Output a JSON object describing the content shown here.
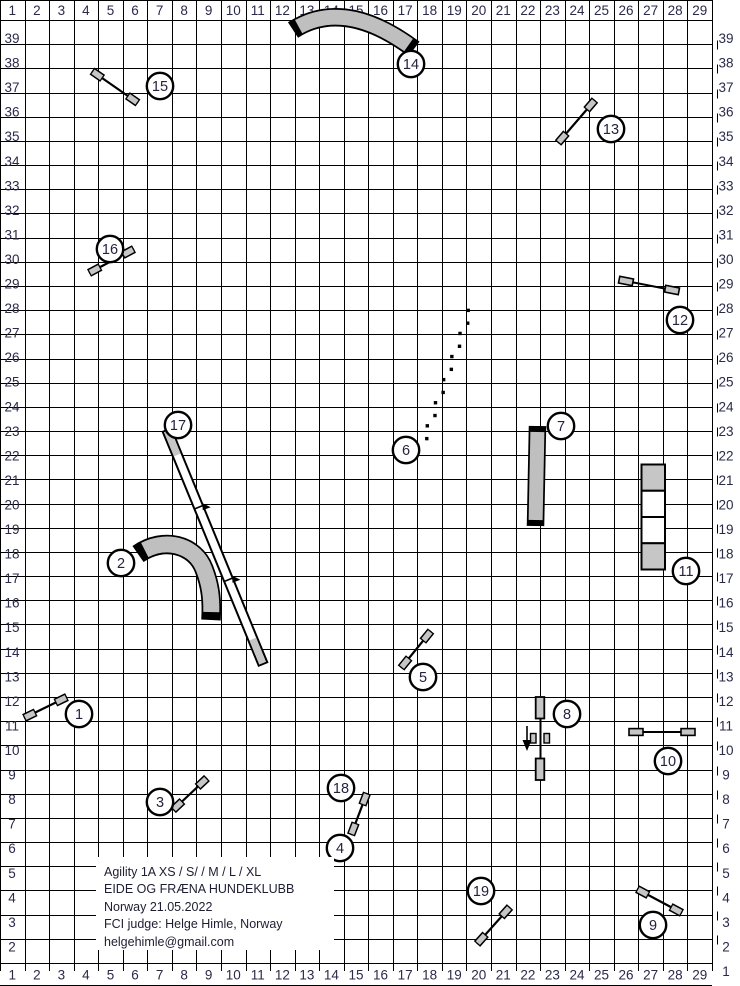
{
  "grid": {
    "columns": [
      "1",
      "2",
      "3",
      "4",
      "5",
      "6",
      "7",
      "8",
      "9",
      "10",
      "11",
      "12",
      "13",
      "14",
      "15",
      "16",
      "17",
      "18",
      "19",
      "20",
      "21",
      "22",
      "23",
      "24",
      "25",
      "26",
      "27",
      "28",
      "29"
    ],
    "rows_left": [
      "39",
      "38",
      "37",
      "36",
      "35",
      "34",
      "33",
      "32",
      "31",
      "30",
      "29",
      "28",
      "27",
      "26",
      "25",
      "24",
      "23",
      "22",
      "21",
      "20",
      "19",
      "18",
      "17",
      "16",
      "15",
      "14",
      "13",
      "12",
      "11",
      "10",
      "9",
      "8",
      "7",
      "6",
      "5",
      "4",
      "3",
      "2"
    ],
    "rows_right": [
      "39",
      "38",
      "37",
      "36",
      "35",
      "34",
      "33",
      "32",
      "31",
      "30",
      "29",
      "28",
      "27",
      "26",
      "25",
      "24",
      "23",
      "22",
      "21",
      "20",
      "19",
      "18",
      "17",
      "16",
      "15",
      "14",
      "13",
      "12",
      "11",
      "10",
      "9",
      "8",
      "7",
      "6",
      "5",
      "4",
      "3",
      "2",
      "1"
    ]
  },
  "info_box": {
    "lines": [
      "Agility 1A XS / S/ / M / L / XL",
      "EIDE OG FRÆNA HUNDEKLUBB",
      "Norway 21.05.2022",
      "FCI judge: Helge Himle, Norway",
      "helgehimle@gmail.com"
    ]
  },
  "course": {
    "colors": {
      "obstacle_gray": "#c6c6c6",
      "tunnel_gray": "#bfbfbf",
      "outline": "#000000",
      "label_color": "#2a2a4a",
      "number_color": "#23233f",
      "grid_line": "#000000"
    },
    "obstacles": [
      {
        "num": "1",
        "type": "jump",
        "x1": 24,
        "y1": 718,
        "x2": 67,
        "y2": 697,
        "cx": 79,
        "cy": 714
      },
      {
        "num": "2",
        "type": "tunnel",
        "path": "M 138,554 C 164,536 195,545 204,569 C 211,587 212,601 211,620",
        "w": 16,
        "inset": 6,
        "cx": 121,
        "cy": 563
      },
      {
        "num": "3",
        "type": "jump",
        "x1": 173,
        "y1": 810,
        "x2": 207,
        "y2": 778,
        "cx": 160,
        "cy": 802
      },
      {
        "num": "4",
        "type": "marker",
        "cx": 340,
        "cy": 848
      },
      {
        "num": "5",
        "type": "jump",
        "x1": 401,
        "y1": 668,
        "x2": 431,
        "y2": 631,
        "cx": 423,
        "cy": 677
      },
      {
        "num": "6",
        "type": "weaves",
        "x1": 470,
        "y1": 311,
        "x2": 425,
        "y2": 438,
        "count": 12,
        "cx": 406,
        "cy": 450
      },
      {
        "num": "7",
        "type": "tunnel",
        "path": "M 537.5,426 L 535.5,526",
        "w": 14,
        "inset": 6,
        "cx": 561,
        "cy": 426
      },
      {
        "num": "8",
        "type": "wall-jump",
        "x": 540,
        "y1": 697,
        "y2": 780,
        "cx": 567,
        "cy": 714
      },
      {
        "num": "9",
        "type": "jump",
        "x1": 637,
        "y1": 889,
        "x2": 682,
        "y2": 913,
        "cx": 653,
        "cy": 925
      },
      {
        "num": "10",
        "type": "wing-jump",
        "x1": 636,
        "y1": 732,
        "x2": 688,
        "y2": 732,
        "cx": 668,
        "cy": 761
      },
      {
        "num": "11",
        "type": "long-jump",
        "x": 641.5,
        "y": 464.5,
        "w": 23.5,
        "h": 105,
        "cx": 686,
        "cy": 571
      },
      {
        "num": "12",
        "type": "wing-jump",
        "x1": 626,
        "y1": 281,
        "x2": 672,
        "y2": 290,
        "cx": 680,
        "cy": 320
      },
      {
        "num": "13",
        "type": "jump",
        "x1": 558,
        "y1": 143,
        "x2": 595,
        "y2": 100,
        "cx": 611,
        "cy": 129
      },
      {
        "num": "14",
        "type": "tunnel",
        "path": "M 293,30 C 322,11 362,10 414,49",
        "w": 15,
        "inset": 5,
        "cx": 411,
        "cy": 64
      },
      {
        "num": "15",
        "type": "jump",
        "x1": 92,
        "y1": 71,
        "x2": 138,
        "y2": 103,
        "cx": 160,
        "cy": 86
      },
      {
        "num": "16",
        "type": "jump",
        "x1": 89,
        "y1": 273,
        "x2": 134,
        "y2": 249,
        "cx": 110,
        "cy": 249
      },
      {
        "num": "17",
        "type": "dog-walk",
        "x1": 167,
        "y1": 430,
        "x2": 263,
        "y2": 664,
        "cx": 178,
        "cy": 425
      },
      {
        "num": "18",
        "type": "jump",
        "x1": 351,
        "y1": 835,
        "x2": 367,
        "y2": 793,
        "cx": 341,
        "cy": 788
      },
      {
        "num": "19",
        "type": "jump",
        "x1": 477,
        "y1": 944,
        "x2": 510,
        "y2": 907,
        "cx": 481,
        "cy": 891
      }
    ]
  }
}
